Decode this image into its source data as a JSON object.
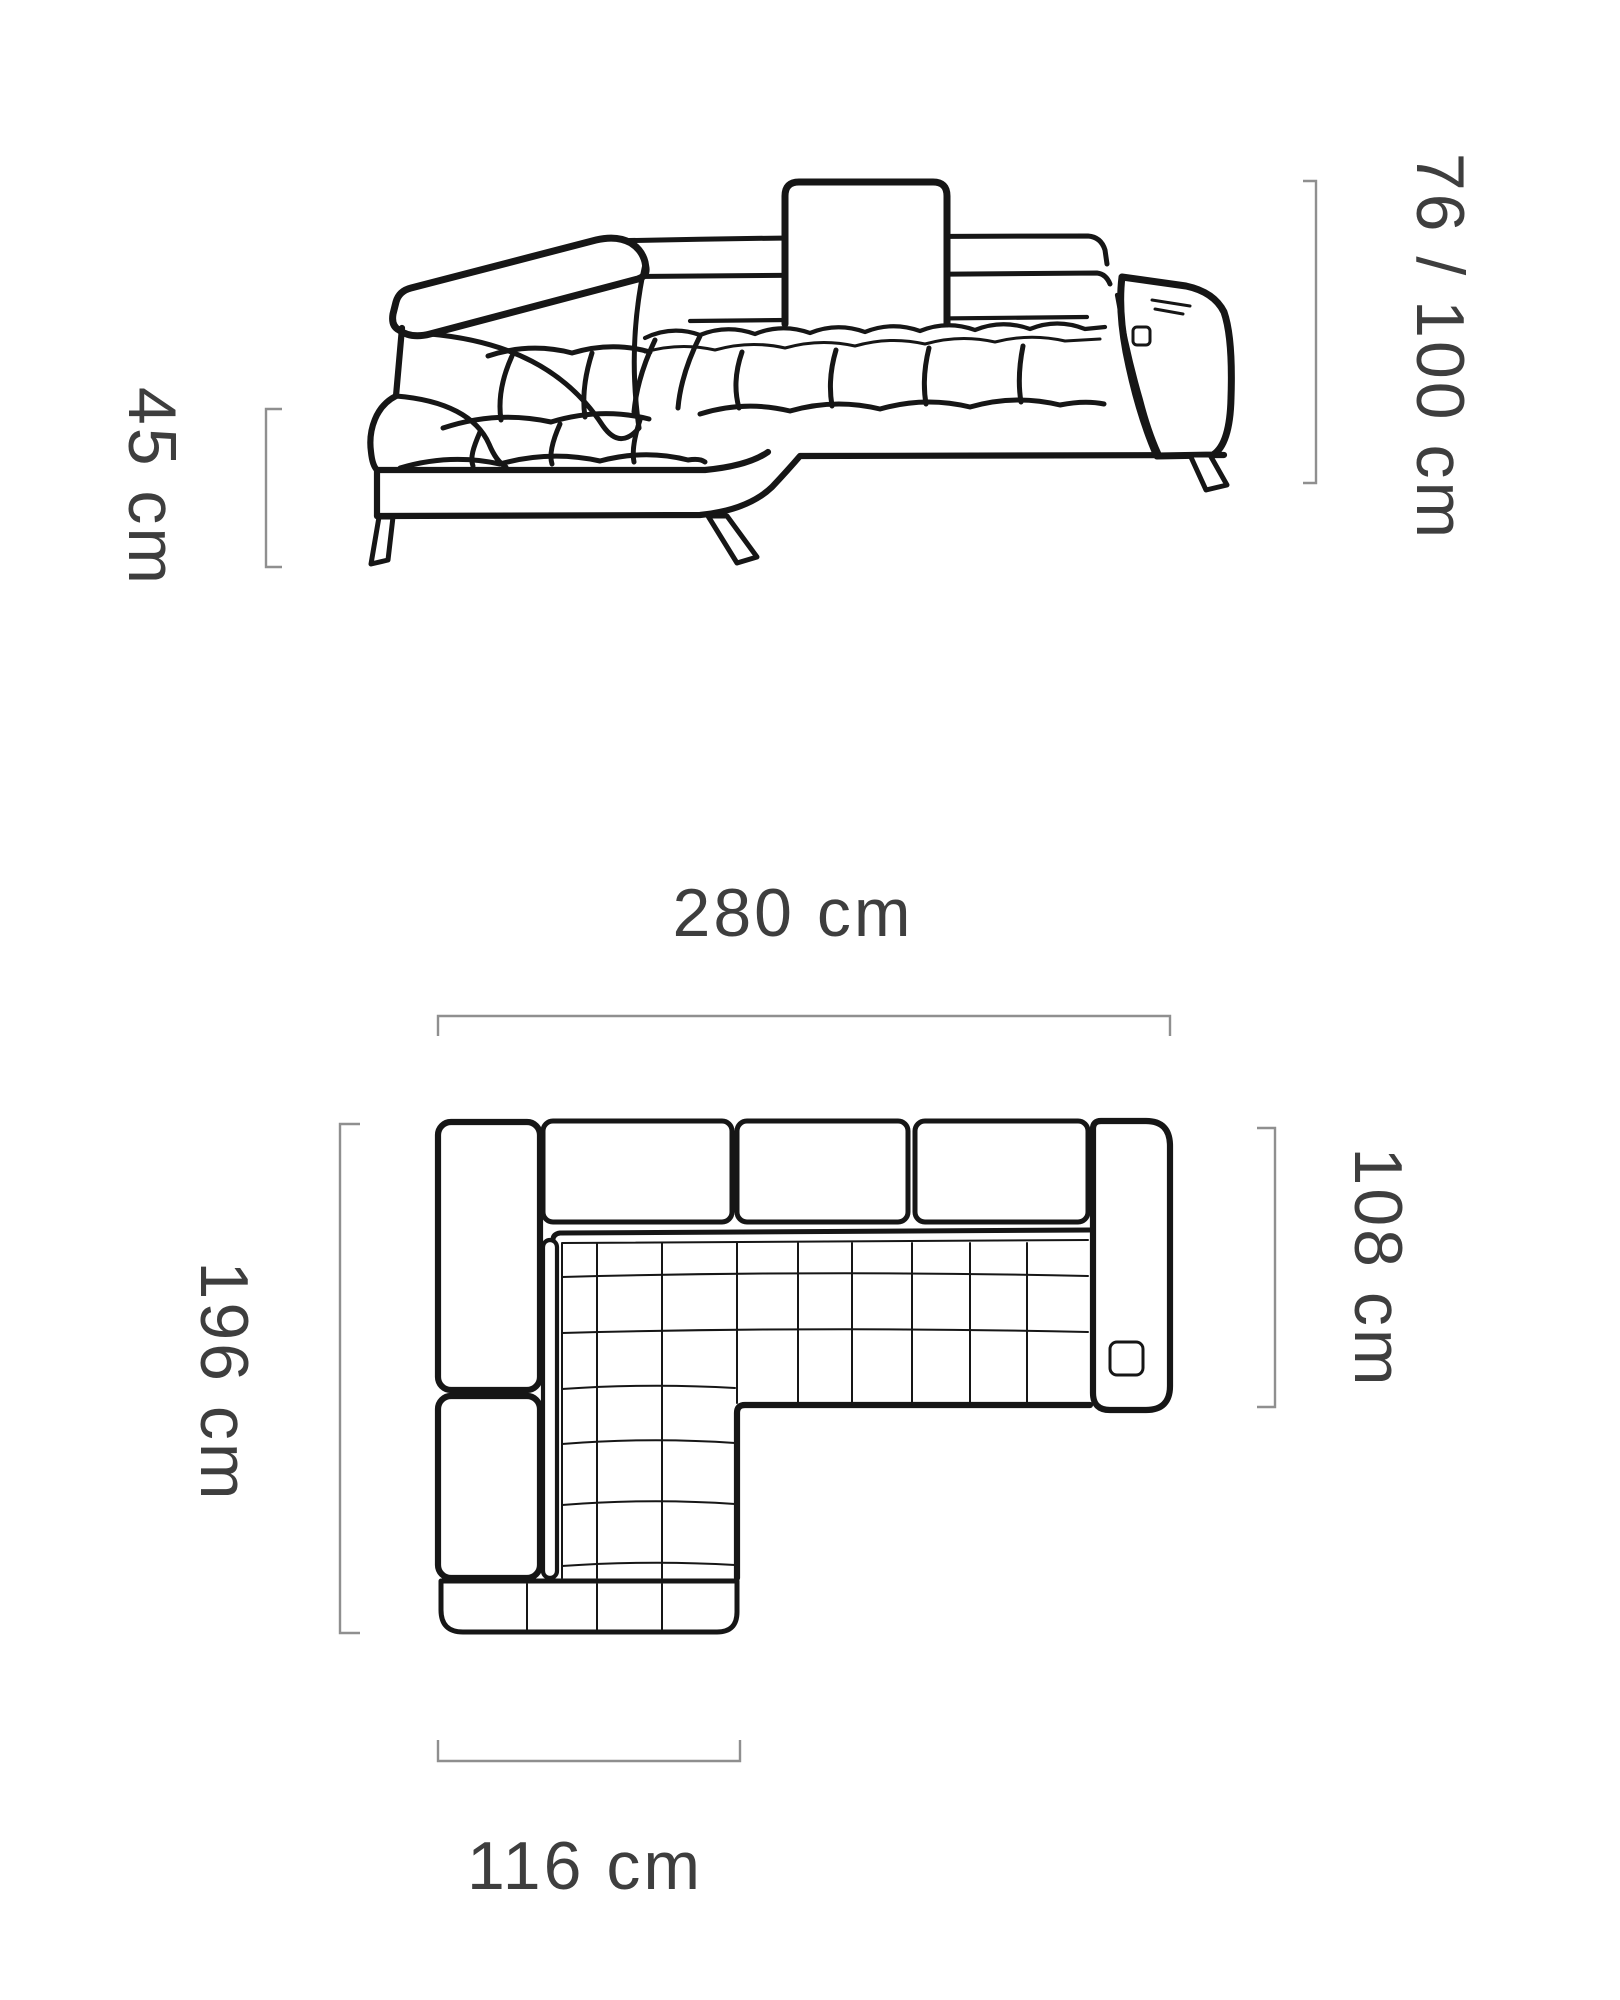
{
  "dimensions": {
    "height": "76 / 100 cm",
    "seat_height": "45 cm",
    "total_width": "280 cm",
    "total_depth": "196 cm",
    "seat_depth": "108 cm",
    "chaise_width": "116 cm"
  },
  "colors": {
    "background": "#ffffff",
    "line": "#161616",
    "bracket": "#8f8f8f",
    "text": "#3e3e3e"
  }
}
